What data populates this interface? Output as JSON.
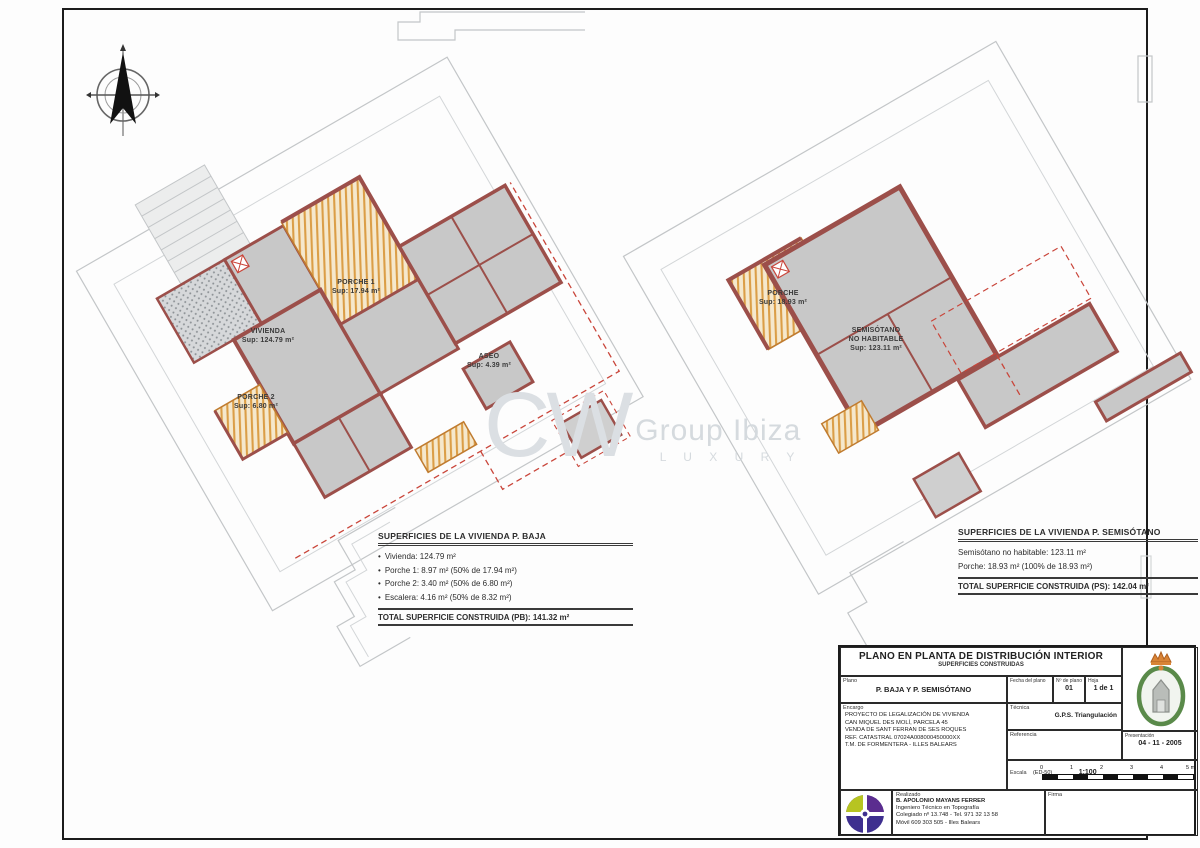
{
  "watermark": {
    "initials": "CW",
    "name": "Group Ibiza",
    "tagline": "L U X U R Y"
  },
  "plans": {
    "left": {
      "rooms": {
        "porche1": {
          "name": "PORCHE 1",
          "area": "Sup: 17.94 m²"
        },
        "vivienda": {
          "name": "VIVIENDA",
          "area": "Sup: 124.79 m²"
        },
        "porche2": {
          "name": "PORCHE 2",
          "area": "Sup: 6.80 m²"
        },
        "aseo": {
          "name": "ASEO",
          "area": "Sup: 4.39 m²"
        }
      },
      "summary": {
        "title": "SUPERFICIES DE LA VIVIENDA P. BAJA",
        "items": [
          "Vivienda: 124.79 m²",
          "Porche 1: 8.97 m² (50% de 17.94 m²)",
          "Porche 2: 3.40 m² (50% de 6.80 m²)",
          "Escalera: 4.16 m² (50% de 8.32 m²)"
        ],
        "total": "TOTAL SUPERFICIE CONSTRUIDA (PB): 141.32 m²"
      }
    },
    "right": {
      "rooms": {
        "porche": {
          "name": "PORCHE",
          "area": "Sup: 18.93 m²"
        },
        "semisotano": {
          "name": "SEMISÓTANO",
          "name2": "NO HABITABLE",
          "area": "Sup: 123.11 m²"
        }
      },
      "summary": {
        "title": "SUPERFICIES DE LA VIVIENDA P. SEMISÓTANO",
        "items": [
          "Semisótano no habitable: 123.11 m²",
          "Porche: 18.93 m² (100% de 18.93 m²)"
        ],
        "total": "TOTAL SUPERFICIE CONSTRUIDA (PS): 142.04 m²"
      }
    }
  },
  "title_block": {
    "title": "PLANO EN PLANTA DE DISTRIBUCIÓN INTERIOR",
    "subtitle": "SUPERFICIES CONSTRUIDAS",
    "plano": {
      "label": "Plano",
      "value": "P. BAJA Y P. SEMISÓTANO"
    },
    "cells": {
      "fecha_plano_label": "Fecha del plano",
      "num_label": "Nº de plano",
      "num_value": "01",
      "hoja_label": "Hoja",
      "hoja_value": "1 de 1",
      "tecnico_label": "Técnica",
      "tecnico_value": "G.P.S. Triangulación",
      "referencia_label": "Referencia",
      "fecha_label": "Presentación",
      "fecha_value": "04 - 11 - 2005"
    },
    "encargo": {
      "label": "Encargo",
      "lines": [
        "PROYECTO DE LEGALIZACIÓN DE VIVIENDA",
        "CAN MIQUEL DES MOLÍ, PARCELA 45",
        "VENDA DE SANT FERRAN DE SES ROQUES",
        "REF. CATASTRAL 07024A008000450000XX",
        "T.M. DE FORMENTERA - ILLES BALEARS"
      ]
    },
    "escala": {
      "label": "Escala",
      "paren": "(ED-50)",
      "ratio": "1:100",
      "ticks": [
        "0",
        "1",
        "2",
        "3",
        "4",
        "5 m"
      ]
    },
    "realizado": {
      "label": "Realizado",
      "lines": [
        "B. APOLONIO MAYANS FERRER",
        "Ingeniero Técnico en Topografía",
        "Colegiado nº 13.748 - Tel. 971 32 13 58",
        "Móvil 609 303 505 - Illes Balears"
      ]
    },
    "firma_label": "Firma"
  },
  "colors": {
    "wall": "#9c4f4a",
    "room_fill": "#c8c8c8",
    "hatch_orange": "#d6912f",
    "dashed_red": "#c9453a",
    "site_gray": "#c3c6c8"
  }
}
